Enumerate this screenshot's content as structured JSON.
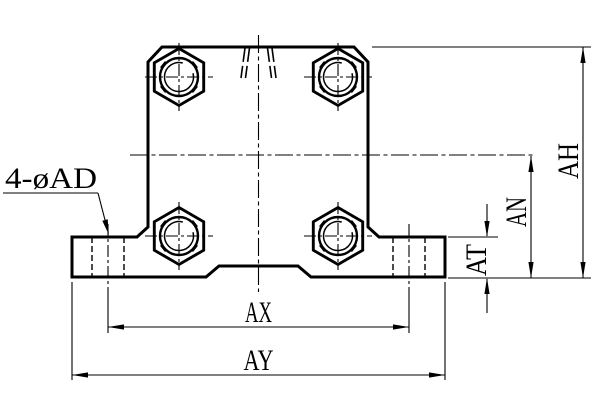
{
  "drawing": {
    "background": "#ffffff",
    "line_color": "#000000",
    "callout": {
      "text": "4-øAD"
    },
    "dimensions": {
      "height_total": "AH",
      "height_to_center": "AN",
      "flange_thickness": "AT",
      "hole_spacing": "AX",
      "base_width": "AY"
    }
  }
}
